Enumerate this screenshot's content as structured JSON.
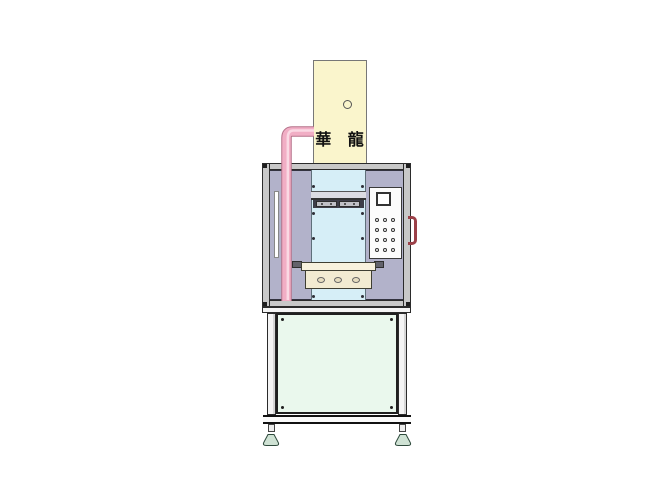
{
  "scene": {
    "background": "#ffffff"
  },
  "machine": {
    "brand": {
      "text": "華 龍"
    },
    "press_column": {
      "hole_count": 1
    },
    "control_panel": {
      "display_count": 1,
      "keypad": {
        "rows": 4,
        "cols": 3,
        "total_buttons": 12
      }
    },
    "tool_blocks": {
      "count": 2
    },
    "work_table": {
      "hole_count": 3
    },
    "guard_panel": {
      "corner_screws": 4
    },
    "feet": {
      "count": 2
    }
  },
  "colors": {
    "bg": "#ffffff",
    "column": "#faf5cc",
    "pipe": "#f1aec5",
    "pipeHi": "#fad9e4",
    "pipeEdge": "#b5728a",
    "rail": "#c8c8c8",
    "panelSide": "#b2b2ca",
    "panelRam": "#d6eef7",
    "beam": "#dcdce2",
    "table": "#f2ebd2",
    "tableHi": "#f8f2de",
    "panelCtrl": "#fcfcfc",
    "handle": "#9b4048",
    "guard": "#eaf8ed",
    "cabinet": "#f4f4f4",
    "foot": "#cfe2d4",
    "ink": "#111111"
  }
}
